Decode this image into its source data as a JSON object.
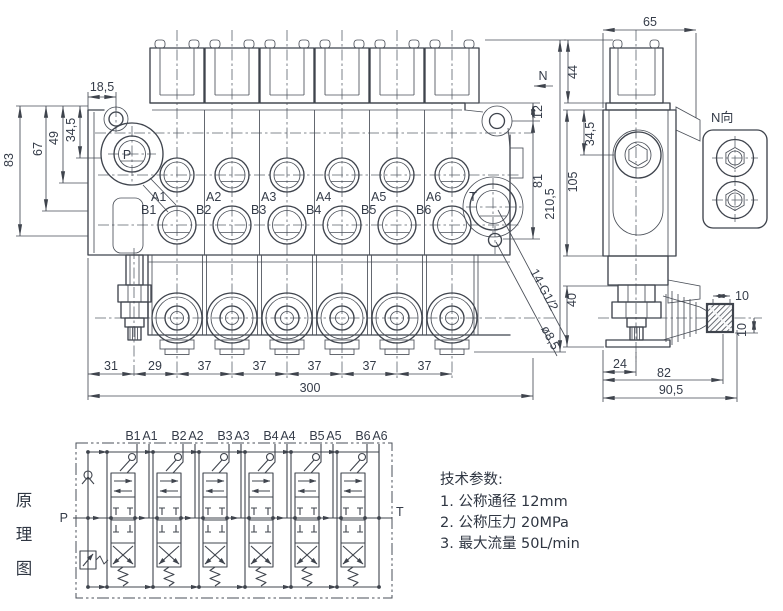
{
  "front_view": {
    "dims": {
      "w18_5": "18,5",
      "h34_5": "34,5",
      "h49": "49",
      "h67": "67",
      "h83": "83",
      "v12": "12",
      "v81": "81",
      "v210_5": "210,5",
      "chain": [
        "31",
        "29",
        "37",
        "37",
        "37",
        "37",
        "37"
      ],
      "total": "300",
      "thread_note": "14-G1/2",
      "hole_note": "ø8,5",
      "view_arrow": "N"
    },
    "ports": {
      "p": "P",
      "t": "T",
      "a": [
        "A1",
        "A2",
        "A3",
        "A4",
        "A5",
        "A6"
      ],
      "b": [
        "B1",
        "B2",
        "B3",
        "B4",
        "B5",
        "B6"
      ]
    }
  },
  "side_view": {
    "dims": {
      "w65": "65",
      "h44": "44",
      "h34_5": "34,5",
      "h105": "105",
      "h40": "40",
      "w24": "24",
      "w82": "82",
      "w90_5": "90,5",
      "w10": "10",
      "h10": "10"
    }
  },
  "n_view": {
    "label": "N向"
  },
  "schematic": {
    "label_chars": [
      "原",
      "理",
      "图"
    ],
    "port_p": "P",
    "port_t": "T",
    "sections": [
      {
        "b": "B1",
        "a": "A1"
      },
      {
        "b": "B2",
        "a": "A2"
      },
      {
        "b": "B3",
        "a": "A3"
      },
      {
        "b": "B4",
        "a": "A4"
      },
      {
        "b": "B5",
        "a": "A5"
      },
      {
        "b": "B6",
        "a": "A6"
      }
    ]
  },
  "tech_params": {
    "title": "技术参数:",
    "items": [
      {
        "label": "1. 公称通径",
        "value": "12mm"
      },
      {
        "label": "2. 公称压力",
        "value": "20MPa"
      },
      {
        "label": "3. 最大流量",
        "value": "50L/min"
      }
    ]
  },
  "colors": {
    "ink": "#3f444d",
    "background": "#ffffff"
  }
}
